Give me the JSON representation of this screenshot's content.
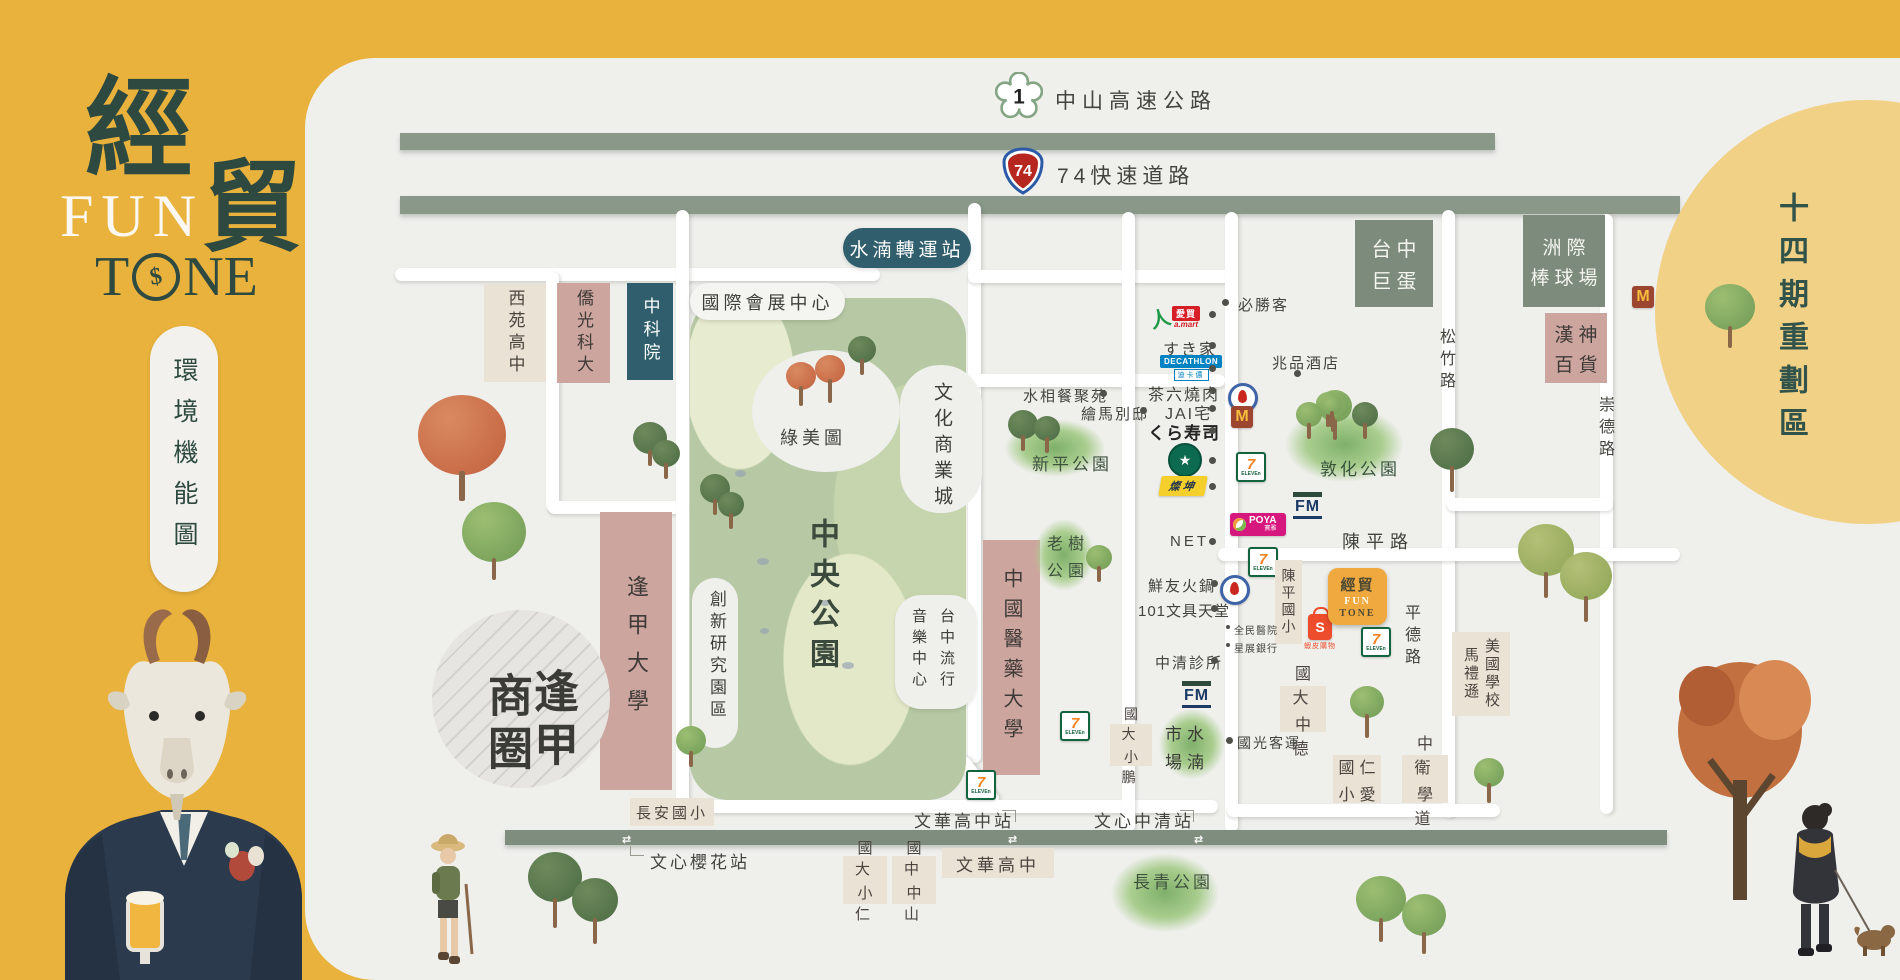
{
  "sidebar": {
    "jing": "經",
    "mao": "貿",
    "fun": "FUN",
    "t": "T",
    "ne": "NE",
    "coin": "$",
    "pill": "環境機能圖"
  },
  "zone": {
    "fourteen": "十四期重劃區"
  },
  "hwy": {
    "n1": "1",
    "n1name": "中山高速公路",
    "n74": "74",
    "n74name": "74快速道路"
  },
  "stations": {
    "hub": "水湳轉運站",
    "wenhua": "文華高中站",
    "zhongqing": "文心中清站",
    "yinghua": "文心櫻花站"
  },
  "roads": {
    "songzhu": "松竹路",
    "chongde": "崇德路",
    "chenping": "陳平路",
    "pingde": "平德路"
  },
  "parks": {
    "central": "中央公園",
    "lvmei": "綠美圖",
    "xinping": "新平公園",
    "laoshu1": "老樹",
    "laoshu2": "公園",
    "dunhua": "敦化公園",
    "changqing": "長青公園"
  },
  "campus": {
    "xiyuan": "西苑高中",
    "qiaoguang": "僑光科大",
    "ncsist": "中科院",
    "expo": "國際會展中心",
    "culture": "文化商業城",
    "music_r": "台中流行",
    "music_l": "音樂中心",
    "innov": "創新研究園區",
    "fengjia": "逢甲大學",
    "biz_r": "逢甲",
    "biz_l": "商圈",
    "cmu": "中國醫藥大學",
    "dome1": "台中",
    "dome2": "巨蛋",
    "ball1": "洲際",
    "ball2": "棒球場",
    "hanshin1": "漢神",
    "hanshin2": "百貨",
    "morrison_r": "馬禮遜",
    "morrison_l": "美國學校",
    "chenping_es": "陳平國小",
    "dade1": "國大",
    "dade2": "中德",
    "dapeng1": "國大",
    "dapeng2": "小鵬",
    "daren1": "國大",
    "daren2": "小仁",
    "zhongshan1": "國中",
    "zhongshan2": "中山",
    "renai1": "國仁",
    "renai2": "小愛",
    "weidao1": "中衛",
    "weidao2": "學道",
    "changan": "長安國小",
    "wenhua_box": "文華高中",
    "market1": "市水",
    "market2": "場湳"
  },
  "pois": {
    "pizzahut": "必勝客",
    "maison": "兆品酒店",
    "sukiya": "すき家",
    "chaliu": "茶六燒肉",
    "jai": "JAI宅",
    "kura": "くら寿司",
    "aqua": "水相餐聚苑",
    "ema": "繪馬別邸",
    "net": "NET",
    "xianyou": "鮮友火鍋",
    "wenju": "101文具天堂",
    "hosp": "全民醫院",
    "dbs": "星展銀行",
    "clinic": "中清診所",
    "bus": "國光客運"
  },
  "brands": {
    "amart1": "愛買",
    "amart2": "a.mart",
    "deca1": "DECATHLON",
    "deca2": "迪卡儂",
    "tk": "燦坤",
    "poya1": "POYA",
    "poya2": "寶雅",
    "fm": "FM",
    "seven": "7",
    "eleven": "ELEVEn",
    "m": "M",
    "s": "S",
    "shopee": "蝦皮購物",
    "site1": "經貿",
    "site2": "FUN",
    "site3": "TONE",
    "sb": "★"
  }
}
